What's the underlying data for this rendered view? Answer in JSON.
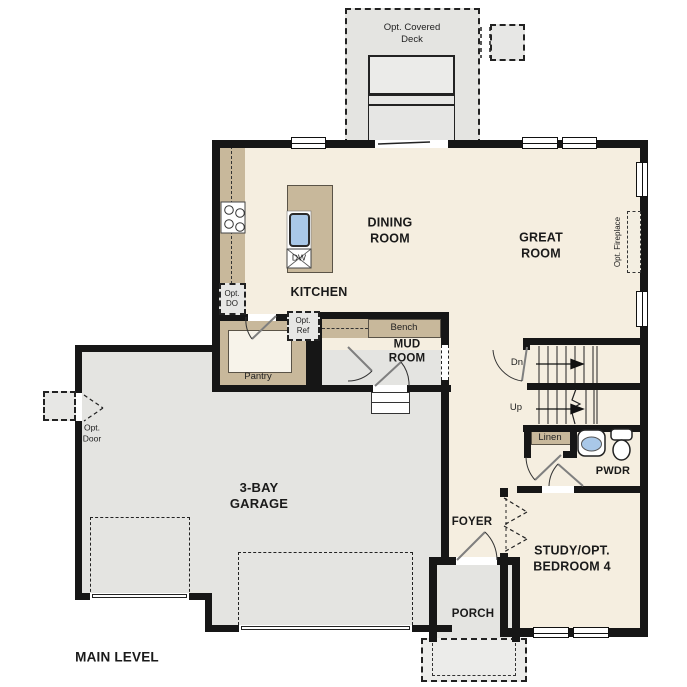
{
  "plan": {
    "title": "MAIN LEVEL",
    "rooms": {
      "deck": "Opt. Covered\nDeck",
      "dining": "DINING\nROOM",
      "great": "GREAT\nROOM",
      "kitchen": "KITCHEN",
      "mud": "MUD\nROOM",
      "garage": "3-BAY\nGARAGE",
      "foyer": "FOYER",
      "porch": "PORCH",
      "study": "STUDY/OPT.\nBEDROOM 4",
      "pwdr": "PWDR",
      "pantry": "Pantry"
    },
    "features": {
      "bench": "Bench",
      "linen": "Linen",
      "dw": "DW",
      "opt_do": "Opt.\nDO",
      "opt_ref": "Opt.\nRef",
      "opt_door": "Opt.\nDoor",
      "opt_fireplace": "Opt. Fireplace",
      "dn": "Dn",
      "up": "Up"
    },
    "colors": {
      "floor": "#f5eee0",
      "hardscape": "#e4e4e1",
      "cabinet_tan": "#c8b89b",
      "sink_blue": "#a9c8e8",
      "wall": "#161616",
      "optional_fill": "#e7e7e5"
    }
  }
}
